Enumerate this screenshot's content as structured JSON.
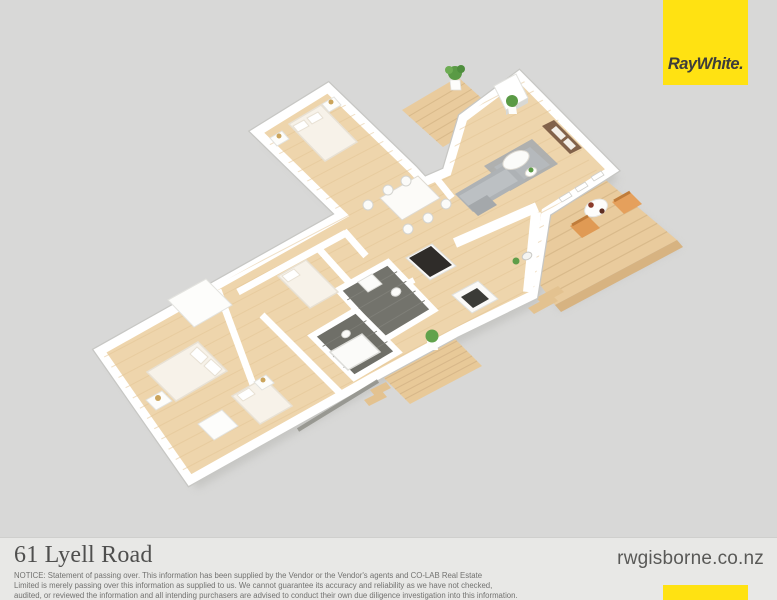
{
  "page": {
    "background": "#d8d8d7",
    "width": 777,
    "height": 600
  },
  "branding": {
    "logo_text": "Ray White.",
    "logo_bg": "#ffe212",
    "logo_text_color": "#3d3d3b",
    "accent_bar_color": "#ffe212",
    "website": "rwgisborne.co.nz"
  },
  "footer": {
    "title": "61 Lyell Road",
    "background": "#e8e8e6",
    "title_color": "#4f4f4e",
    "notice_color": "#727270",
    "website_color": "#595957",
    "notice_lines": [
      "NOTICE: Statement of passing over. This information has been supplied by the Vendor or the Vendor's agents and CO-LAB Real Estate",
      "Limited is merely passing over this information as supplied to us. We cannot guarantee its accuracy and reliability as we have not checked,",
      "audited, or reviewed the information and all intending purchasers are advised to conduct their own due diligence investigation into this information."
    ]
  },
  "floorplan": {
    "palette": {
      "floor_wood": "#eed5ac",
      "deck_wood": "#e9cb9d",
      "walls": "#ffffff",
      "tile_dark": "#73736c",
      "sofa_gray": "#aeb2b5",
      "rug_gray": "#a7acaf",
      "chair_orange": "#e09a54",
      "plant_green": "#5a9a45",
      "lamp_gold": "#cba45b"
    },
    "shapes": [
      {
        "n": "house-shadow",
        "t": "poly",
        "p": "100,351 342,215 257,132 328,88 413,170 424,182 447,172 463,118 519,76 612,170 546,212 533,295 455,333 372,378 190,480",
        "f": "#b5b5b1",
        "o": 0.5,
        "dx": 7,
        "dy": 9,
        "blur": true
      },
      {
        "n": "deck-right-shadow",
        "t": "poly",
        "p": "558,140 677,240 555,305 470,190",
        "f": "#bdbdb9",
        "o": 0.4,
        "dx": 5,
        "dy": 7,
        "blur": true
      },
      {
        "n": "deck-right",
        "t": "poly",
        "id": "deckR",
        "p": "558,140 677,240 555,305 470,190",
        "f": "#e9cb9d"
      },
      {
        "n": "deck-right-boards",
        "t": "boards",
        "a": [
          470,
          190
        ],
        "b": [
          555,
          305
        ],
        "c": [
          558,
          140
        ],
        "d": [
          677,
          240
        ],
        "k": 12,
        "s": "#d9ba8b",
        "w": 1.2
      },
      {
        "n": "deck-right-fascia",
        "t": "poly",
        "p": "555,305 677,240 683,247 561,312",
        "f": "#d7b381"
      },
      {
        "n": "deck-right-step-1",
        "t": "poly",
        "p": "536,298 558,286 564,292 542,304",
        "f": "#e3c290"
      },
      {
        "n": "deck-right-step-2",
        "t": "poly",
        "p": "528,308 552,295 558,301 534,314",
        "f": "#e3c290"
      },
      {
        "n": "deck-top",
        "t": "poly",
        "p": "402,110 458,77 499,114 443,147",
        "f": "#e9cb9d"
      },
      {
        "n": "deck-top-boards",
        "t": "boards",
        "a": [
          402,
          110
        ],
        "b": [
          443,
          147
        ],
        "c": [
          458,
          77
        ],
        "d": [
          499,
          114
        ],
        "k": 6,
        "s": "#d9ba8b",
        "w": 1.1
      },
      {
        "n": "deck-bottom",
        "t": "poly",
        "p": "380,374 452,336 482,366 410,404",
        "f": "#e8c998"
      },
      {
        "n": "deck-bottom-boards",
        "t": "boards",
        "a": [
          380,
          374
        ],
        "b": [
          410,
          404
        ],
        "c": [
          452,
          336
        ],
        "d": [
          482,
          366
        ],
        "k": 6,
        "s": "#d8b88a",
        "w": 1.1
      },
      {
        "n": "deck-bottom-step-1",
        "t": "poly",
        "p": "370,390 386,382 391,388 375,396",
        "f": "#e3c290"
      },
      {
        "n": "deck-bottom-step-2",
        "t": "poly",
        "p": "364,400 382,391 387,397 369,406",
        "f": "#e3c290"
      },
      {
        "n": "exterior-wall-shading",
        "t": "poly",
        "p": "100,351 342,215 257,132 328,88 413,170 424,182 447,172 463,118 519,76 612,170 546,212 533,295 455,333 372,378 190,480",
        "f": "none",
        "s": "#c7c7c4",
        "w": 11.5
      },
      {
        "n": "house-footprint",
        "t": "poly",
        "id": "house",
        "p": "100,351 342,215 257,132 328,88 413,170 424,182 447,172 463,118 519,76 612,170 546,212 533,295 455,333 372,378 190,480",
        "f": "#eed5ac",
        "s": "#ffffff",
        "w": 9
      },
      {
        "n": "floor-planks",
        "t": "boards",
        "a": [
          22,
          260
        ],
        "b": [
          190,
          480
        ],
        "c": [
          482,
          20
        ],
        "d": [
          650,
          240
        ],
        "k": 22,
        "s": "#e3c596",
        "w": 1,
        "o": 0.55,
        "clip": "house"
      },
      {
        "n": "wall-master-east",
        "t": "line",
        "x1": 218,
        "y1": 290,
        "x2": 258,
        "y2": 398,
        "s": "#ffffff",
        "w": 7
      },
      {
        "n": "wall-hall-south",
        "t": "line",
        "x1": 238,
        "y1": 292,
        "x2": 346,
        "y2": 233,
        "s": "#ffffff",
        "w": 7
      },
      {
        "n": "wall-dining-west",
        "t": "line",
        "x1": 344,
        "y1": 231,
        "x2": 366,
        "y2": 256,
        "s": "#ffffff",
        "w": 7
      },
      {
        "n": "wall-bedroom2-east",
        "t": "line",
        "x1": 318,
        "y1": 248,
        "x2": 356,
        "y2": 290,
        "s": "#ffffff",
        "w": 7
      },
      {
        "n": "wall-bath-divider",
        "t": "line",
        "x1": 352,
        "y1": 312,
        "x2": 414,
        "y2": 280,
        "s": "#ffffff",
        "w": 6
      },
      {
        "n": "wall-bedroom3-east",
        "t": "line",
        "x1": 262,
        "y1": 315,
        "x2": 342,
        "y2": 395,
        "s": "#ffffff",
        "w": 7
      },
      {
        "n": "wall-kitchen-counter",
        "t": "line",
        "x1": 455,
        "y1": 243,
        "x2": 537,
        "y2": 207,
        "s": "#ffffff",
        "w": 10
      },
      {
        "n": "wall-kitchen-east-counter",
        "t": "line",
        "x1": 536,
        "y1": 212,
        "x2": 528,
        "y2": 292,
        "s": "#ffffff",
        "w": 10
      },
      {
        "n": "wall-dining-living-stub",
        "t": "line",
        "x1": 436,
        "y1": 178,
        "x2": 452,
        "y2": 198,
        "s": "#ffffff",
        "w": 7
      },
      {
        "n": "wardrobe",
        "t": "poly",
        "p": "168,300 206,279 232,305 194,327",
        "f": "#fdfdfb",
        "s": "#e3e3df",
        "w": 1
      },
      {
        "n": "bathroom-floor-1",
        "t": "poly",
        "id": "b1",
        "p": "338,290 388,262 434,310 384,340",
        "f": "#73736c",
        "s": "#ffffff",
        "w": 6
      },
      {
        "n": "bathroom-tiles-1",
        "t": "boards",
        "a": [
          338,
          290
        ],
        "b": [
          384,
          340
        ],
        "c": [
          388,
          262
        ],
        "d": [
          434,
          310
        ],
        "k": 5,
        "s": "#7f7f78",
        "w": 1,
        "clip": "b1"
      },
      {
        "n": "bathroom-floor-2",
        "t": "poly",
        "id": "b2",
        "p": "312,336 356,310 398,352 354,378",
        "f": "#6f6f68",
        "s": "#ffffff",
        "w": 6
      },
      {
        "n": "bathroom-tiles-2",
        "t": "boards",
        "a": [
          312,
          336
        ],
        "b": [
          354,
          378
        ],
        "c": [
          356,
          310
        ],
        "d": [
          398,
          352
        ],
        "k": 4,
        "s": "#7b7b74",
        "w": 1,
        "clip": "b2"
      },
      {
        "n": "toilet-1",
        "t": "ell",
        "cx": 396,
        "cy": 292,
        "rx": 5,
        "ry": 4,
        "rot": -25,
        "f": "#fbfbf9",
        "s": "#d8d8d4",
        "w": 1
      },
      {
        "n": "toilet-2",
        "t": "ell",
        "cx": 346,
        "cy": 334,
        "rx": 4.5,
        "ry": 3.5,
        "rot": -25,
        "f": "#fbfbf9",
        "s": "#d8d8d4",
        "w": 1
      },
      {
        "n": "bathtub",
        "t": "poly",
        "p": "330,352 362,334 380,352 348,370",
        "f": "#fbfbf9",
        "s": "#dcdcd8",
        "w": 1.5
      },
      {
        "n": "vanity",
        "t": "poly",
        "p": "358,282 372,274 382,284 368,292",
        "f": "#fbfbf9",
        "s": "#dcdcd8",
        "w": 1
      },
      {
        "n": "bed-master",
        "t": "poly",
        "p": "198,342 227,371 176,401 147,372",
        "f": "#f7f2e9",
        "s": "#e8e1d4",
        "w": 1.5
      },
      {
        "n": "pillow-master-1",
        "t": "poly",
        "p": "197,347 208,357 201,364 190,354",
        "f": "#ffffff",
        "s": "#e8e1d4",
        "w": 1
      },
      {
        "n": "pillow-master-2",
        "t": "poly",
        "p": "211,359 222,369 215,376 204,366",
        "f": "#ffffff",
        "s": "#e8e1d4",
        "w": 1
      },
      {
        "n": "nightstand-master",
        "t": "poly",
        "p": "146,400 162,391 172,401 156,410",
        "f": "#fdfdfb",
        "s": "#e3e3df",
        "w": 1
      },
      {
        "n": "lamp-master",
        "t": "circ",
        "cx": 158,
        "cy": 398,
        "r": 3,
        "f": "#cba45b"
      },
      {
        "n": "dresser-master",
        "t": "poly",
        "p": "198,424 222,410 238,426 214,440",
        "f": "#fdfdfb",
        "s": "#e3e3df",
        "w": 1
      },
      {
        "n": "bed-wing",
        "t": "poly",
        "p": "289,124 321,105 357,142 325,161",
        "f": "#f7f2e9",
        "s": "#e8e1d4",
        "w": 1.5
      },
      {
        "n": "pillow-wing-1",
        "t": "poly",
        "p": "293,126 304,120 309,126 298,132",
        "f": "#ffffff",
        "s": "#e8e1d4",
        "w": 1
      },
      {
        "n": "pillow-wing-2",
        "t": "poly",
        "p": "307,118 318,112 323,118 312,124",
        "f": "#ffffff",
        "s": "#e8e1d4",
        "w": 1
      },
      {
        "n": "nightstand-wing-1",
        "t": "poly",
        "p": "270,138 282,131 289,139 277,146",
        "f": "#fdfdfb",
        "s": "#e3e3df",
        "w": 1
      },
      {
        "n": "lamp-wing-1",
        "t": "circ",
        "cx": 279,
        "cy": 136,
        "r": 2.5,
        "f": "#cba45b"
      },
      {
        "n": "nightstand-wing-2",
        "t": "poly",
        "p": "322,104 334,97 341,105 329,112",
        "f": "#fdfdfb",
        "s": "#e3e3df",
        "w": 1
      },
      {
        "n": "lamp-wing-2",
        "t": "circ",
        "cx": 331,
        "cy": 102,
        "r": 2.5,
        "f": "#cba45b"
      },
      {
        "n": "bed-2",
        "t": "poly",
        "p": "278,276 306,260 338,292 310,308",
        "f": "#f7f2e9",
        "s": "#e8e1d4",
        "w": 1.5
      },
      {
        "n": "pillow-2",
        "t": "poly",
        "p": "282,276 294,269 300,275 288,282",
        "f": "#ffffff",
        "s": "#e8e1d4",
        "w": 1
      },
      {
        "n": "bed-3",
        "t": "poly",
        "p": "232,396 264,378 292,406 260,424",
        "f": "#f7f2e9",
        "s": "#e8e1d4",
        "w": 1.5
      },
      {
        "n": "pillow-3",
        "t": "poly",
        "p": "237,395 249,388 255,394 243,401",
        "f": "#ffffff",
        "s": "#e8e1d4",
        "w": 1
      },
      {
        "n": "nightstand-3",
        "t": "poly",
        "p": "254,382 266,375 274,383 262,390",
        "f": "#fdfdfb",
        "s": "#e3e3df",
        "w": 1
      },
      {
        "n": "lamp-3",
        "t": "circ",
        "cx": 263,
        "cy": 380,
        "r": 2.5,
        "f": "#cba45b"
      },
      {
        "n": "dining-table",
        "t": "poly",
        "p": "380,198 418,176 440,198 402,220",
        "f": "#fcfbf8",
        "s": "#dedad2",
        "w": 1
      },
      {
        "n": "dining-chair-1",
        "t": "circ",
        "cx": 388,
        "cy": 190,
        "r": 5,
        "f": "#fbfbf9",
        "s": "#d4d4d0",
        "w": 1
      },
      {
        "n": "dining-chair-2",
        "t": "circ",
        "cx": 406,
        "cy": 181,
        "r": 5,
        "f": "#fbfbf9",
        "s": "#d4d4d0",
        "w": 1
      },
      {
        "n": "dining-chair-3",
        "t": "circ",
        "cx": 408,
        "cy": 229,
        "r": 5,
        "f": "#fbfbf9",
        "s": "#d4d4d0",
        "w": 1
      },
      {
        "n": "dining-chair-4",
        "t": "circ",
        "cx": 428,
        "cy": 218,
        "r": 5,
        "f": "#fbfbf9",
        "s": "#d4d4d0",
        "w": 1
      },
      {
        "n": "dining-chair-5",
        "t": "circ",
        "cx": 368,
        "cy": 205,
        "r": 5,
        "f": "#fbfbf9",
        "s": "#d4d4d0",
        "w": 1
      },
      {
        "n": "dining-chair-6",
        "t": "circ",
        "cx": 446,
        "cy": 204,
        "r": 5,
        "f": "#fbfbf9",
        "s": "#d4d4d0",
        "w": 1
      },
      {
        "n": "kitchen-island",
        "t": "poly",
        "p": "406,258 432,244 456,266 430,280",
        "f": "#fbfaf8",
        "s": "#e0e0dc",
        "w": 1
      },
      {
        "n": "kitchen-island-top",
        "t": "poly",
        "p": "409,258 431,246 452,265 430,277",
        "f": "#2f2c29"
      },
      {
        "n": "kitchen-counter-run",
        "t": "poly",
        "p": "452,295 478,281 498,299 472,313",
        "f": "#fbfaf8",
        "s": "#e0e0dc",
        "w": 1
      },
      {
        "n": "cooktop",
        "t": "poly",
        "p": "461,297 477,288 489,299 473,308",
        "f": "#3b3b37"
      },
      {
        "n": "kitchen-sink",
        "t": "ell",
        "cx": 527,
        "cy": 256,
        "rx": 5,
        "ry": 3.5,
        "rot": -25,
        "f": "#f4f4f2",
        "s": "#c9c9c5",
        "w": 1
      },
      {
        "n": "plant-kitchen",
        "t": "circ",
        "cx": 516,
        "cy": 261,
        "r": 3.5,
        "f": "#5f9e49"
      },
      {
        "n": "living-rug",
        "t": "poly",
        "p": "484,166 532,139 558,164 510,191",
        "f": "#a7acaf",
        "o": 0.9
      },
      {
        "n": "living-rug-inner",
        "t": "poly",
        "p": "494,167 530,147 550,165 514,185",
        "f": "#b6bbbe",
        "o": 0.85
      },
      {
        "n": "sofa-base",
        "t": "poly",
        "p": "455,194 508,163 526,181 473,212",
        "f": "#aeb2b5"
      },
      {
        "n": "sofa-cushions",
        "t": "poly",
        "p": "459,196 506,169 518,181 471,208",
        "f": "#bcc0c3"
      },
      {
        "n": "sofa-chaise",
        "t": "poly",
        "p": "468,206 487,195 497,205 478,216",
        "f": "#a4a8ab"
      },
      {
        "n": "coffee-table",
        "t": "ell",
        "cx": 516,
        "cy": 160,
        "rx": 14,
        "ry": 8,
        "rot": -26,
        "f": "#fbfbf9",
        "s": "#ddd9d1",
        "w": 1
      },
      {
        "n": "side-table",
        "t": "ell",
        "cx": 531,
        "cy": 172,
        "rx": 6,
        "ry": 4,
        "rot": -26,
        "f": "#fdfdfb",
        "s": "#ddd9d1",
        "w": 1
      },
      {
        "n": "plant-side-table",
        "t": "circ",
        "cx": 531,
        "cy": 170,
        "r": 2.5,
        "f": "#5a9a45"
      },
      {
        "n": "tv-cabinet",
        "t": "poly",
        "p": "554,120 582,148 570,154 542,126",
        "f": "#82624a"
      },
      {
        "n": "tv-cabinet-drawer-1",
        "t": "poly",
        "p": "556,126 566,136 561,140 551,130",
        "f": "#f4efe8"
      },
      {
        "n": "tv-cabinet-drawer-2",
        "t": "poly",
        "p": "568,138 576,146 571,150 563,142",
        "f": "#f4efe8"
      },
      {
        "n": "chimney-pillar",
        "t": "poly",
        "p": "494,86 516,74 528,98 506,110",
        "f": "#ffffff",
        "s": "#e2e2de",
        "w": 1
      },
      {
        "n": "chimney-pillar-side",
        "t": "poly",
        "p": "506,110 528,98 528,103 506,115",
        "f": "#d8d8d4"
      },
      {
        "n": "slider-door-panel-1",
        "t": "poly",
        "p": "591,177 601,171 604,175 594,181",
        "f": "#ffffff",
        "s": "#cfcfcb",
        "w": 0.8
      },
      {
        "n": "slider-door-panel-2",
        "t": "poly",
        "p": "575,188 585,182 588,186 578,192",
        "f": "#ffffff",
        "s": "#cfcfcb",
        "w": 0.8
      },
      {
        "n": "slider-door-panel-3",
        "t": "poly",
        "p": "559,198 569,192 572,196 562,202",
        "f": "#ffffff",
        "s": "#cfcfcb",
        "w": 0.8
      },
      {
        "n": "outdoor-table",
        "t": "ell",
        "cx": 596,
        "cy": 208,
        "rx": 12,
        "ry": 8,
        "rot": -25,
        "f": "#fdfdfb",
        "s": "#e4e4e0",
        "w": 1
      },
      {
        "n": "outdoor-plate-1",
        "t": "circ",
        "cx": 591,
        "cy": 205,
        "r": 2.8,
        "f": "#8a3a28"
      },
      {
        "n": "outdoor-plate-2",
        "t": "circ",
        "cx": 602,
        "cy": 211,
        "r": 2.6,
        "f": "#5f2f22"
      },
      {
        "n": "outdoor-chair-1",
        "t": "poly",
        "p": "570,226 588,216 600,228 582,238",
        "f": "#e09a54"
      },
      {
        "n": "outdoor-chair-1-back",
        "t": "line",
        "x1": 572,
        "y1": 225,
        "x2": 588,
        "y2": 216,
        "s": "#c07c3a",
        "w": 3
      },
      {
        "n": "outdoor-chair-2",
        "t": "poly",
        "p": "612,202 630,192 642,204 624,214",
        "f": "#e5a05c"
      },
      {
        "n": "outdoor-chair-2-back",
        "t": "line",
        "x1": 614,
        "y1": 201,
        "x2": 630,
        "y2": 192,
        "s": "#c07c3a",
        "w": 3
      },
      {
        "n": "plant-topdeck-pot",
        "t": "poly",
        "p": "450,80 460,80 461,90 451,90",
        "f": "#fdfdfb",
        "s": "#e0e0dc",
        "w": 0.8
      },
      {
        "n": "plant-topdeck",
        "t": "circ",
        "cx": 455,
        "cy": 73,
        "r": 7,
        "f": "#5a9a45"
      },
      {
        "n": "plant-topdeck-2",
        "t": "circ",
        "cx": 449,
        "cy": 70,
        "r": 4,
        "f": "#6dac53"
      },
      {
        "n": "plant-topdeck-3",
        "t": "circ",
        "cx": 461,
        "cy": 69,
        "r": 4,
        "f": "#4e8e3d"
      },
      {
        "n": "plant-living-pot",
        "t": "poly",
        "p": "508,107 516,107 517,114 509,114",
        "f": "#fdfdfb"
      },
      {
        "n": "plant-living",
        "t": "circ",
        "cx": 512,
        "cy": 101,
        "r": 6,
        "f": "#5a9a45"
      },
      {
        "n": "plant-bottomdeck-pot",
        "t": "poly",
        "p": "427,341 437,341 438,350 428,350",
        "f": "#fdfdfb"
      },
      {
        "n": "plant-bottomdeck",
        "t": "circ",
        "cx": 432,
        "cy": 336,
        "r": 6.5,
        "f": "#61a24b"
      },
      {
        "n": "se-wall-shadow",
        "t": "line",
        "x1": 298,
        "y1": 430,
        "x2": 378,
        "y2": 381,
        "s": "#8f8f88",
        "w": 4,
        "o": 0.85
      }
    ]
  }
}
